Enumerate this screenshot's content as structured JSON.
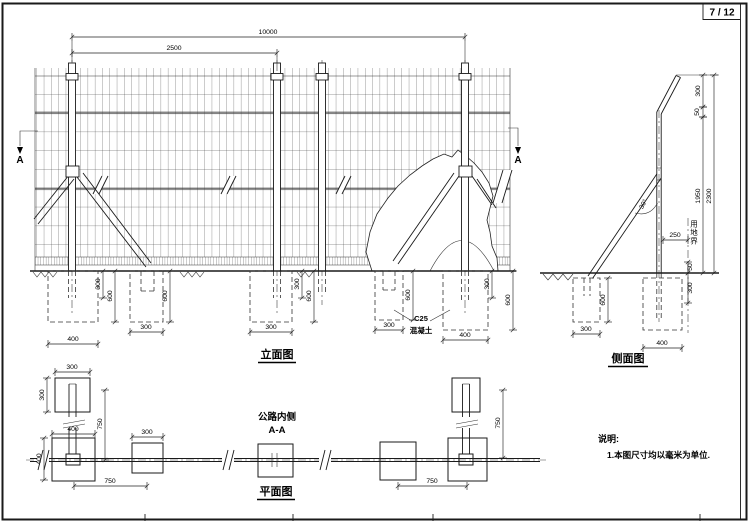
{
  "sheet": {
    "page_number": "7 / 12"
  },
  "elevation": {
    "title": "立面图",
    "marker_left": "A",
    "marker_right": "A",
    "concrete_grade": "C25",
    "concrete_material": "混凝土"
  },
  "side": {
    "title": "侧面图",
    "land_boundary": "用地界",
    "brace_angle": "30°"
  },
  "plan": {
    "title": "平面图",
    "road_side": "公路内侧",
    "section": "A-A"
  },
  "notes": {
    "heading": "说明:",
    "line1": "1.本图尺寸均以毫米为单位."
  },
  "dims": [
    {
      "t": "10000",
      "x1": 72,
      "y1": 37,
      "x2": 465,
      "y2": 37,
      "tx": 268,
      "ty": 34,
      "rot": 0
    },
    {
      "t": "2500",
      "x1": 72,
      "y1": 53,
      "x2": 277,
      "y2": 53,
      "tx": 174,
      "ty": 50,
      "rot": 0
    },
    {
      "t": "300",
      "x1": 103,
      "y1": 271,
      "x2": 103,
      "y2": 298,
      "tx": 100,
      "ty": 284,
      "rot": -90
    },
    {
      "t": "600",
      "x1": 115,
      "y1": 271,
      "x2": 115,
      "y2": 322,
      "tx": 112,
      "ty": 296,
      "rot": -90
    },
    {
      "t": "400",
      "x1": 48,
      "y1": 344,
      "x2": 98,
      "y2": 344,
      "tx": 73,
      "ty": 341,
      "rot": 0
    },
    {
      "t": "600",
      "x1": 170,
      "y1": 271,
      "x2": 170,
      "y2": 322,
      "tx": 167,
      "ty": 296,
      "rot": -90
    },
    {
      "t": "300",
      "x1": 130,
      "y1": 332,
      "x2": 163,
      "y2": 332,
      "tx": 146,
      "ty": 329,
      "rot": 0
    },
    {
      "t": "300",
      "x1": 302,
      "y1": 271,
      "x2": 302,
      "y2": 298,
      "tx": 299,
      "ty": 284,
      "rot": -90
    },
    {
      "t": "600",
      "x1": 314,
      "y1": 271,
      "x2": 314,
      "y2": 322,
      "tx": 311,
      "ty": 296,
      "rot": -90
    },
    {
      "t": "300",
      "x1": 250,
      "y1": 332,
      "x2": 292,
      "y2": 332,
      "tx": 271,
      "ty": 329,
      "rot": 0
    },
    {
      "t": "300",
      "x1": 375,
      "y1": 330,
      "x2": 403,
      "y2": 330,
      "tx": 389,
      "ty": 327,
      "rot": 0
    },
    {
      "t": "600",
      "x1": 413,
      "y1": 271,
      "x2": 413,
      "y2": 320,
      "tx": 410,
      "ty": 295,
      "rot": -90
    },
    {
      "t": "400",
      "x1": 443,
      "y1": 340,
      "x2": 488,
      "y2": 340,
      "tx": 465,
      "ty": 337,
      "rot": 0
    },
    {
      "t": "300",
      "x1": 492,
      "y1": 271,
      "x2": 492,
      "y2": 298,
      "tx": 489,
      "ty": 284,
      "rot": -90
    },
    {
      "t": "600",
      "x1": 513,
      "y1": 271,
      "x2": 513,
      "y2": 330,
      "tx": 510,
      "ty": 300,
      "rot": -90
    },
    {
      "t": "300",
      "x1": 703,
      "y1": 75,
      "x2": 703,
      "y2": 107,
      "tx": 700,
      "ty": 91,
      "rot": -90
    },
    {
      "t": "50",
      "x1": 703,
      "y1": 107,
      "x2": 703,
      "y2": 117,
      "tx": 699,
      "ty": 112,
      "rot": -90
    },
    {
      "t": "1950",
      "x1": 703,
      "y1": 117,
      "x2": 703,
      "y2": 273,
      "tx": 700,
      "ty": 196,
      "rot": -90
    },
    {
      "t": "2300",
      "x1": 714,
      "y1": 75,
      "x2": 714,
      "y2": 273,
      "tx": 711,
      "ty": 196,
      "rot": -90
    },
    {
      "t": "250",
      "x1": 663,
      "y1": 240,
      "x2": 688,
      "y2": 240,
      "tx": 675,
      "ty": 237,
      "rot": 0
    },
    {
      "t": "50",
      "x1": 688,
      "y1": 262,
      "x2": 688,
      "y2": 273,
      "tx": 692,
      "ty": 267,
      "rot": -90
    },
    {
      "t": "300",
      "x1": 688,
      "y1": 273,
      "x2": 688,
      "y2": 303,
      "tx": 692,
      "ty": 288,
      "rot": -90
    },
    {
      "t": "300",
      "x1": 573,
      "y1": 334,
      "x2": 600,
      "y2": 334,
      "tx": 586,
      "ty": 331,
      "rot": 0
    },
    {
      "t": "600",
      "x1": 608,
      "y1": 278,
      "x2": 608,
      "y2": 322,
      "tx": 605,
      "ty": 300,
      "rot": -90
    },
    {
      "t": "400",
      "x1": 643,
      "y1": 348,
      "x2": 682,
      "y2": 348,
      "tx": 662,
      "ty": 345,
      "rot": 0
    },
    {
      "t": "300",
      "x1": 55,
      "y1": 372,
      "x2": 90,
      "y2": 372,
      "tx": 72,
      "ty": 369,
      "rot": 0
    },
    {
      "t": "300",
      "x1": 47,
      "y1": 378,
      "x2": 47,
      "y2": 412,
      "tx": 44,
      "ty": 395,
      "rot": -90
    },
    {
      "t": "400",
      "x1": 52,
      "y1": 434,
      "x2": 95,
      "y2": 434,
      "tx": 73,
      "ty": 431,
      "rot": 0
    },
    {
      "t": "400",
      "x1": 44,
      "y1": 438,
      "x2": 44,
      "y2": 480,
      "tx": 41,
      "ty": 459,
      "rot": -90
    },
    {
      "t": "300",
      "x1": 132,
      "y1": 437,
      "x2": 163,
      "y2": 437,
      "tx": 147,
      "ty": 434,
      "rot": 0
    },
    {
      "t": "750",
      "x1": 105,
      "y1": 390,
      "x2": 105,
      "y2": 460,
      "tx": 102,
      "ty": 424,
      "rot": -90
    },
    {
      "t": "750",
      "x1": 74,
      "y1": 486,
      "x2": 147,
      "y2": 486,
      "tx": 110,
      "ty": 483,
      "rot": 0
    },
    {
      "t": "750",
      "x1": 503,
      "y1": 390,
      "x2": 503,
      "y2": 458,
      "tx": 500,
      "ty": 423,
      "rot": -90
    },
    {
      "t": "750",
      "x1": 398,
      "y1": 486,
      "x2": 467,
      "y2": 486,
      "tx": 432,
      "ty": 483,
      "rot": 0
    }
  ]
}
